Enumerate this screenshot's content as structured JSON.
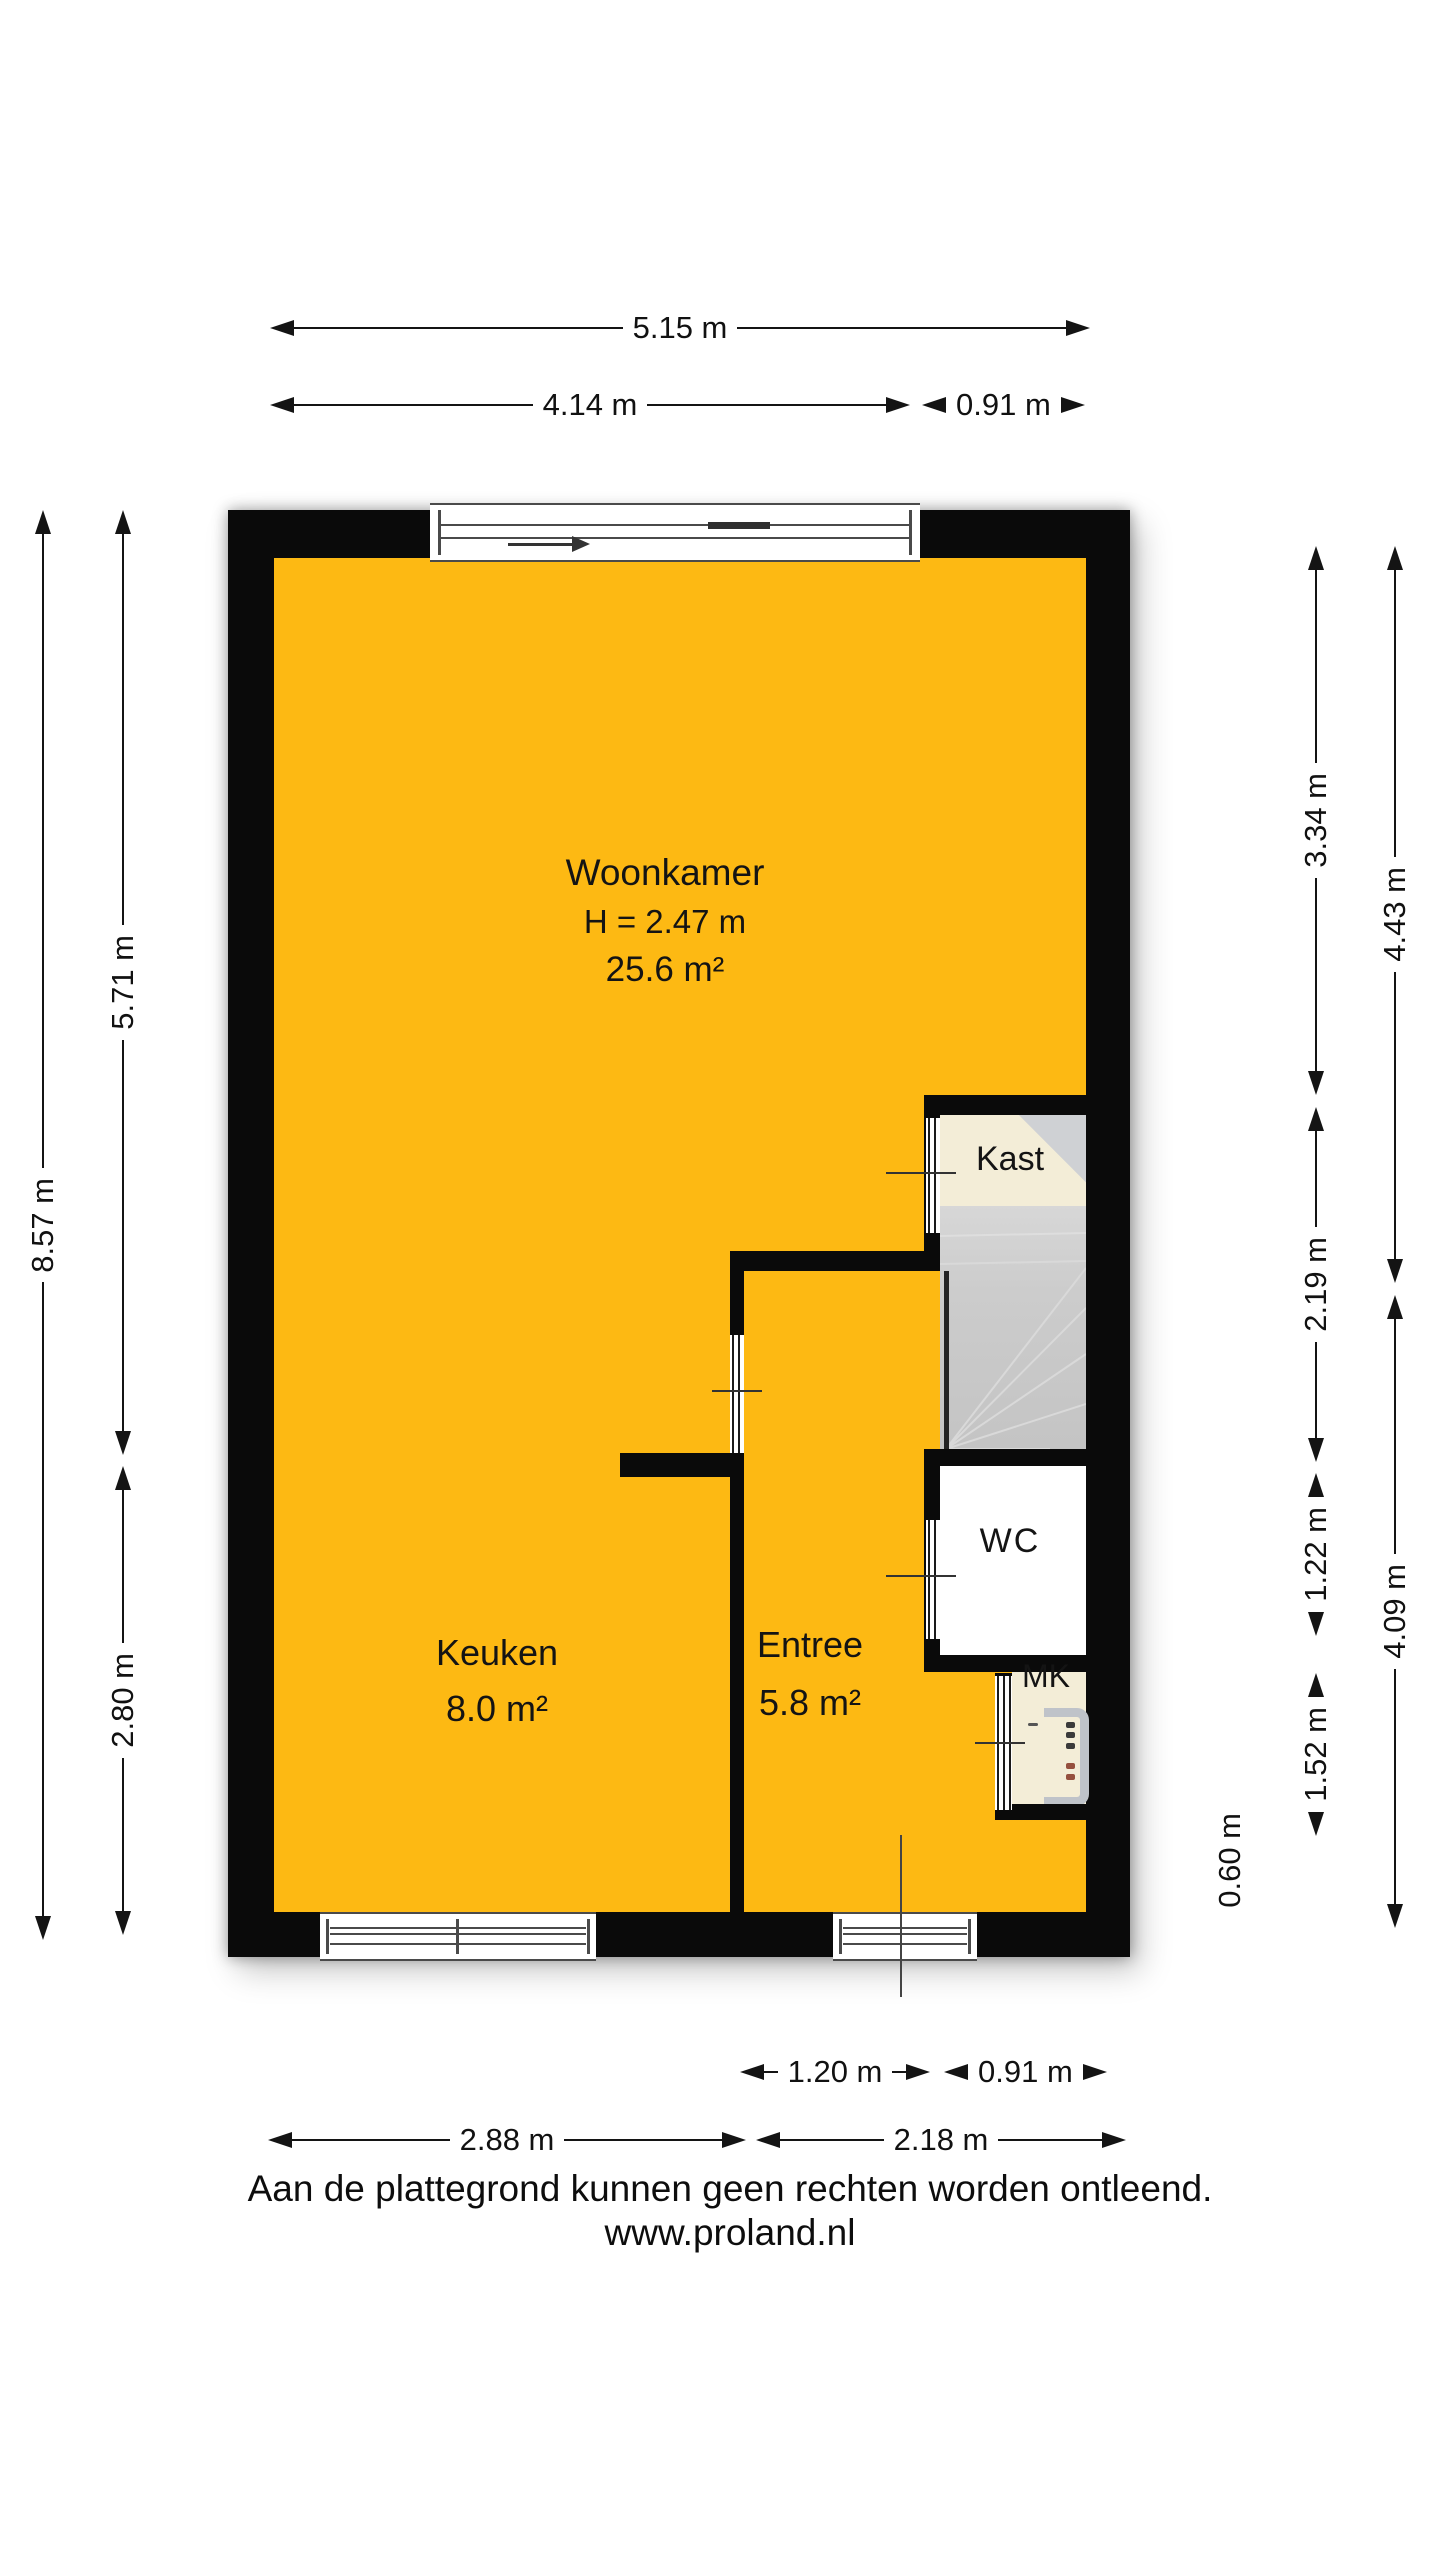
{
  "plan": {
    "colors": {
      "floor_orange": "#FDB913",
      "wall_black": "#0A0A0A",
      "closet_cream": "#F3EDD7",
      "stair_gray": "#C9C9C9",
      "wc_white": "#FFFFFF"
    },
    "rooms": {
      "woonkamer": {
        "name": "Woonkamer",
        "ceiling_height": "H = 2.47 m",
        "area": "25.6 m²"
      },
      "keuken": {
        "name": "Keuken",
        "area": "8.0 m²"
      },
      "entree": {
        "name": "Entree",
        "area": "5.8 m²"
      },
      "kast": {
        "name": "Kast"
      },
      "wc": {
        "name": "WC"
      },
      "mk": {
        "name": "MK"
      }
    }
  },
  "dimensions": {
    "top_total": "5.15 m",
    "top_left": "4.14 m",
    "top_right": "0.91 m",
    "left_total": "8.57 m",
    "left_upper": "5.71 m",
    "left_lower": "2.80 m",
    "right_inner_1": "3.34 m",
    "right_inner_2": "2.19 m",
    "right_inner_3": "1.22 m",
    "right_inner_4": "1.52 m",
    "right_outer_upper": "4.43 m",
    "right_outer_lower": "4.09 m",
    "right_small": "0.60 m",
    "bottom_inner_left": "1.20 m",
    "bottom_inner_right": "0.91 m",
    "bottom_left": "2.88 m",
    "bottom_right": "2.18 m"
  },
  "footer": {
    "disclaimer": "Aan de plattegrond kunnen geen rechten worden ontleend.",
    "website": "www.proland.nl"
  }
}
